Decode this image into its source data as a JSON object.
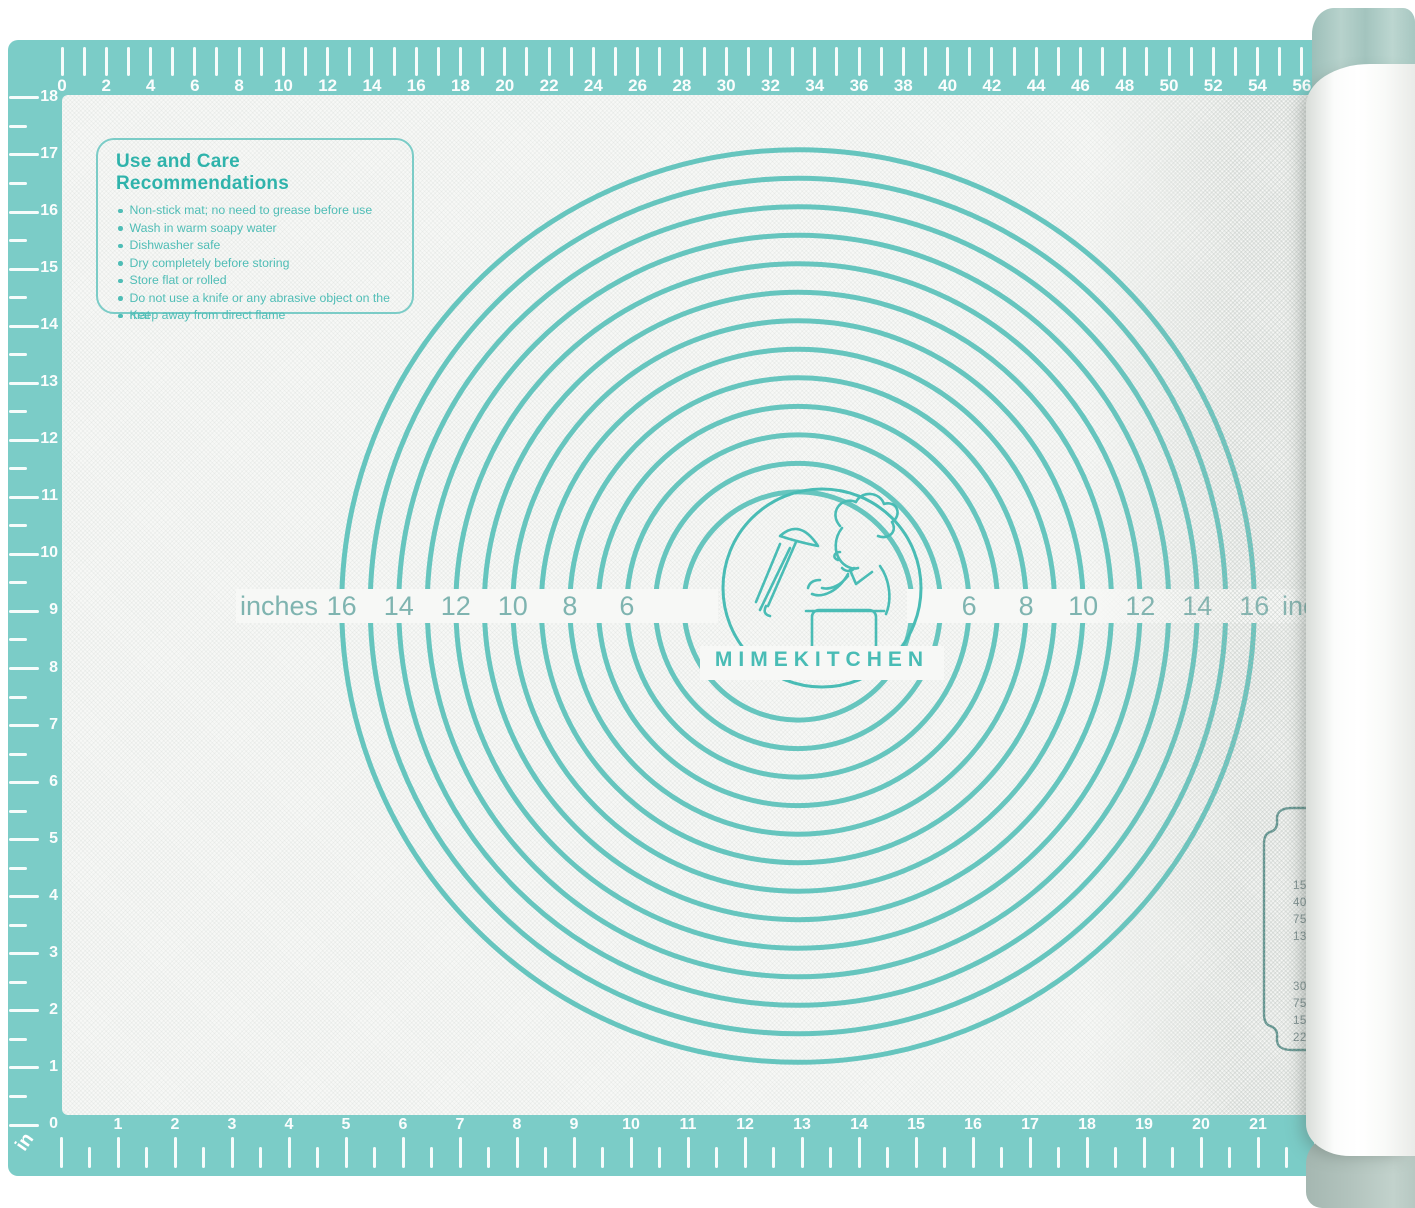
{
  "product": {
    "brand_logo": "MIMEKITCHEN"
  },
  "care_box": {
    "title": "Use and Care Recommendations",
    "bullets": [
      "Non-stick mat; no need to grease before use",
      "Wash in warm soapy water",
      "Dishwasher safe",
      "Dry completely before storing",
      "Store flat or rolled",
      "Do not use a knife or any abrasive object on the mat",
      "Keep away from direct flame"
    ]
  },
  "circle_gauge": {
    "unit_label_left": "inches",
    "unit_label_right": "inches",
    "diameter_labels_left": [
      16,
      14,
      12,
      10,
      8,
      6
    ],
    "diameter_labels_right": [
      6,
      8,
      10,
      12,
      14,
      16
    ],
    "ring_diameters_inches": [
      4,
      5,
      6,
      7,
      8,
      9,
      10,
      11,
      12,
      13,
      14,
      15,
      16
    ]
  },
  "rulers": {
    "top_cm": {
      "min": 0,
      "max": 56,
      "numbered_every": 2
    },
    "bottom_inches": {
      "min": 0,
      "max": 22,
      "numbered_every": 1
    },
    "left_inches": {
      "min": 0,
      "max": 18,
      "numbered_every": 1
    },
    "corner_unit": "in"
  },
  "conversion_chart": {
    "visible_values_top": [
      "15",
      "40",
      "75",
      "13"
    ],
    "visible_values_bottom": [
      "30",
      "75",
      "15",
      "22"
    ]
  },
  "colors": {
    "mat_teal": "#7bccc7",
    "ring_teal": "#66c5be",
    "gauge_label_teal": "#7fb4b0",
    "care_title_teal": "#2fb3ab",
    "care_text_teal": "#4fbdb6",
    "logo_teal": "#49bcb5",
    "plaque_line": "#5e938e",
    "plaque_text": "#76898b",
    "roll_cap": "#a7c7c1",
    "roll_band": "#b2c3bd",
    "ruler_ink": "#ffffff"
  }
}
